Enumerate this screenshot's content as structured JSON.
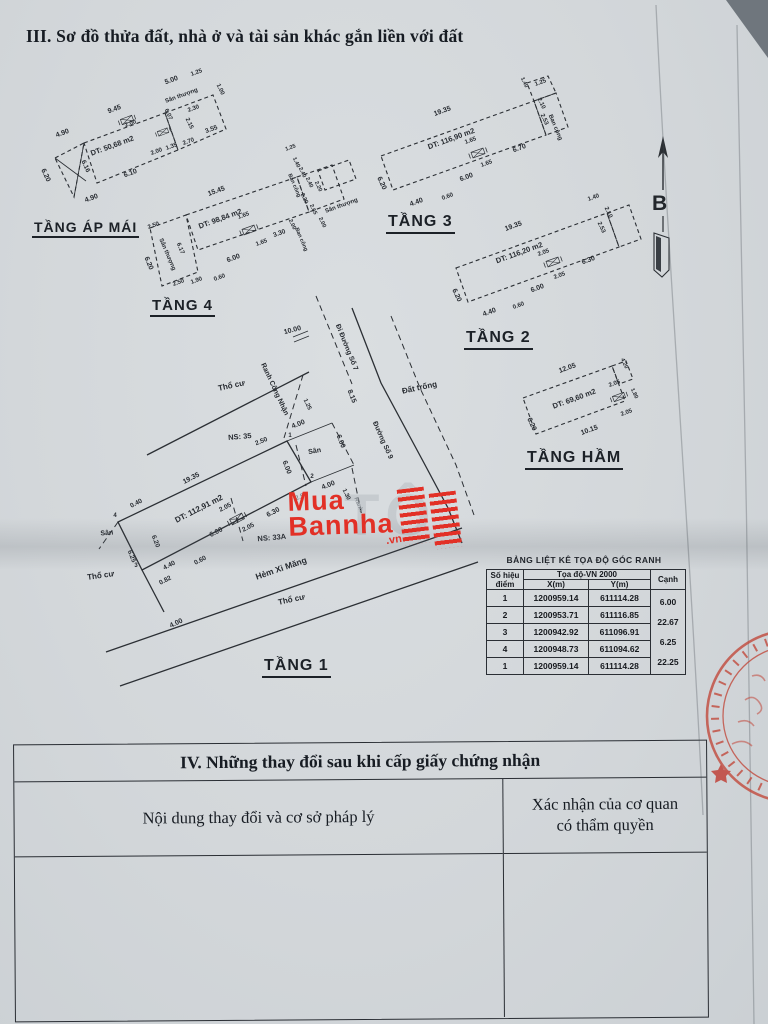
{
  "title": "III. Sơ đồ thửa đất, nhà ở và tài sản khác gắn liền với đất",
  "north": {
    "label": "B"
  },
  "watermark": {
    "l1": "Mua",
    "l2": "Bannha",
    "vn": ".vn",
    "ghost": "TÔ",
    "color": "#e23026"
  },
  "floor_labels": [
    {
      "t": "TẦNG ÁP MÁI",
      "x": 32,
      "y": 219,
      "s": 14
    },
    {
      "t": "TẦNG 4",
      "x": 150,
      "y": 297,
      "s": 15
    },
    {
      "t": "TẦNG 3",
      "x": 386,
      "y": 213,
      "s": 16
    },
    {
      "t": "TẦNG 2",
      "x": 464,
      "y": 329,
      "s": 16
    },
    {
      "t": "TẦNG HẦM",
      "x": 525,
      "y": 449,
      "s": 16
    },
    {
      "t": "TẦNG 1",
      "x": 262,
      "y": 657,
      "s": 16
    }
  ],
  "coord_table": {
    "title": "BẢNG LIỆT KÊ TỌA ĐỘ GÓC RANH",
    "header": {
      "point_l1": "Số hiệu",
      "point_l2": "điểm",
      "coord": "Tọa độ-VN 2000",
      "x": "X(m)",
      "y": "Y(m)",
      "edge": "Cạnh"
    },
    "rows": [
      {
        "pt": "1",
        "x": "1200959.14",
        "y": "611114.28"
      },
      {
        "pt": "2",
        "x": "1200953.71",
        "y": "611116.85"
      },
      {
        "pt": "3",
        "x": "1200942.92",
        "y": "611096.91"
      },
      {
        "pt": "4",
        "x": "1200948.73",
        "y": "611094.62"
      },
      {
        "pt": "1",
        "x": "1200959.14",
        "y": "611114.28"
      }
    ],
    "edges": [
      "6.00",
      "22.67",
      "6.25",
      "22.25"
    ]
  },
  "section4": {
    "title": "IV. Những thay đổi sau khi cấp giấy chứng nhận",
    "col_content": "Nội dung thay đổi và cơ sở pháp lý",
    "col_confirm_l1": "Xác nhận của cơ quan",
    "col_confirm_l2": "có thẩm quyền"
  },
  "drawing": {
    "labels": [
      {
        "t": "9.45",
        "x": 115,
        "y": 111,
        "r": -20,
        "s": 7
      },
      {
        "t": "5.00",
        "x": 172,
        "y": 82,
        "r": -20,
        "s": 7
      },
      {
        "t": "1.25",
        "x": 197,
        "y": 74,
        "r": -20,
        "s": 6
      },
      {
        "t": "4.90",
        "x": 63,
        "y": 135,
        "r": -20,
        "s": 7
      },
      {
        "t": "6.20",
        "x": 44,
        "y": 176,
        "r": 65,
        "s": 7
      },
      {
        "t": "6.16",
        "x": 84,
        "y": 167,
        "r": 65,
        "s": 6.5
      },
      {
        "t": "4.90",
        "x": 92,
        "y": 200,
        "r": -20,
        "s": 7
      },
      {
        "t": "DT: 50,68 m2",
        "x": 113,
        "y": 148,
        "r": -20,
        "s": 7.5
      },
      {
        "t": "Sân thượng",
        "x": 182,
        "y": 97,
        "r": -20,
        "s": 6
      },
      {
        "t": "2.00",
        "x": 131,
        "y": 125,
        "r": -20,
        "s": 6
      },
      {
        "t": "6.07",
        "x": 167,
        "y": 115,
        "r": 65,
        "s": 6
      },
      {
        "t": "2.30",
        "x": 194,
        "y": 110,
        "r": -20,
        "s": 6
      },
      {
        "t": "2.15",
        "x": 188,
        "y": 124,
        "r": 65,
        "s": 6
      },
      {
        "t": "3.55",
        "x": 212,
        "y": 131,
        "r": -20,
        "s": 6.5
      },
      {
        "t": "2.00",
        "x": 157,
        "y": 153,
        "r": -20,
        "s": 6
      },
      {
        "t": "1.35",
        "x": 172,
        "y": 148,
        "r": -20,
        "s": 6
      },
      {
        "t": "2.70",
        "x": 189,
        "y": 143,
        "r": -20,
        "s": 6
      },
      {
        "t": "6.10",
        "x": 131,
        "y": 175,
        "r": -20,
        "s": 7
      },
      {
        "t": "1.00",
        "x": 219,
        "y": 90,
        "r": 65,
        "s": 6
      },
      {
        "t": "15.45",
        "x": 217,
        "y": 193,
        "r": -20,
        "s": 7
      },
      {
        "t": "2.50",
        "x": 154,
        "y": 227,
        "r": -20,
        "s": 6
      },
      {
        "t": "Sân thượng",
        "x": 166,
        "y": 255,
        "r": 67,
        "s": 6
      },
      {
        "t": "6.20",
        "x": 147,
        "y": 264,
        "r": 67,
        "s": 7
      },
      {
        "t": "6.17",
        "x": 179,
        "y": 249,
        "r": 67,
        "s": 6
      },
      {
        "t": "DT: 98,84 m2",
        "x": 221,
        "y": 221,
        "r": -20,
        "s": 7.5
      },
      {
        "t": "1.65",
        "x": 244,
        "y": 217,
        "r": -20,
        "s": 6
      },
      {
        "t": "6.00",
        "x": 234,
        "y": 260,
        "r": -20,
        "s": 7
      },
      {
        "t": "1.65",
        "x": 262,
        "y": 244,
        "r": -20,
        "s": 6
      },
      {
        "t": "3.30",
        "x": 280,
        "y": 235,
        "r": -20,
        "s": 6.5
      },
      {
        "t": "2.50",
        "x": 179,
        "y": 284,
        "r": -20,
        "s": 6
      },
      {
        "t": "1.90",
        "x": 197,
        "y": 282,
        "r": -20,
        "s": 6
      },
      {
        "t": "0.60",
        "x": 220,
        "y": 279,
        "r": -20,
        "s": 6
      },
      {
        "t": "1.25",
        "x": 291,
        "y": 149,
        "r": -20,
        "s": 5.5
      },
      {
        "t": "1.40",
        "x": 295,
        "y": 163,
        "r": 65,
        "s": 5.5
      },
      {
        "t": "2.40",
        "x": 301,
        "y": 173,
        "r": 65,
        "s": 5.5
      },
      {
        "t": "2.40",
        "x": 308,
        "y": 183,
        "r": 65,
        "s": 5.5
      },
      {
        "t": "2.20",
        "x": 317,
        "y": 187,
        "r": 65,
        "s": 5.5
      },
      {
        "t": "Ban công",
        "x": 293,
        "y": 186,
        "r": 67,
        "s": 5.5
      },
      {
        "t": "2.20",
        "x": 303,
        "y": 199,
        "r": 65,
        "s": 5.5
      },
      {
        "t": "2.65",
        "x": 312,
        "y": 210,
        "r": 65,
        "s": 5.5
      },
      {
        "t": "2.00",
        "x": 321,
        "y": 223,
        "r": 65,
        "s": 5.5
      },
      {
        "t": "Sân thượng",
        "x": 342,
        "y": 207,
        "r": -20,
        "s": 6
      },
      {
        "t": "2.00",
        "x": 291,
        "y": 225,
        "r": 65,
        "s": 5.5
      },
      {
        "t": "Ban công",
        "x": 300,
        "y": 240,
        "r": 67,
        "s": 5.5
      },
      {
        "t": "19.35",
        "x": 443,
        "y": 113,
        "r": -20,
        "s": 7
      },
      {
        "t": "DT: 116,90 m2",
        "x": 452,
        "y": 141,
        "r": -20,
        "s": 7.5
      },
      {
        "t": "1.25",
        "x": 541,
        "y": 84,
        "r": -20,
        "s": 6
      },
      {
        "t": "1.40",
        "x": 523,
        "y": 83,
        "r": 65,
        "s": 5.5
      },
      {
        "t": "2.10",
        "x": 540,
        "y": 104,
        "r": 65,
        "s": 6
      },
      {
        "t": "2.53",
        "x": 543,
        "y": 120,
        "r": 65,
        "s": 6
      },
      {
        "t": "Ban công",
        "x": 554,
        "y": 128,
        "r": 67,
        "s": 6
      },
      {
        "t": "1.65",
        "x": 471,
        "y": 142,
        "r": -20,
        "s": 6
      },
      {
        "t": "6.70",
        "x": 520,
        "y": 150,
        "r": -20,
        "s": 7
      },
      {
        "t": "1.65",
        "x": 487,
        "y": 165,
        "r": -20,
        "s": 6
      },
      {
        "t": "6.00",
        "x": 467,
        "y": 179,
        "r": -20,
        "s": 7
      },
      {
        "t": "6.20",
        "x": 380,
        "y": 184,
        "r": 65,
        "s": 7
      },
      {
        "t": "4.40",
        "x": 417,
        "y": 204,
        "r": -20,
        "s": 7
      },
      {
        "t": "0.60",
        "x": 448,
        "y": 198,
        "r": -20,
        "s": 6
      },
      {
        "t": "19.35",
        "x": 514,
        "y": 228,
        "r": -20,
        "s": 7
      },
      {
        "t": "DT: 116,20 m2",
        "x": 520,
        "y": 255,
        "r": -20,
        "s": 7.5
      },
      {
        "t": "1.40",
        "x": 594,
        "y": 199,
        "r": -20,
        "s": 6
      },
      {
        "t": "2.10",
        "x": 607,
        "y": 213,
        "r": 65,
        "s": 6
      },
      {
        "t": "2.53",
        "x": 600,
        "y": 228,
        "r": 65,
        "s": 6
      },
      {
        "t": "2.05",
        "x": 544,
        "y": 254,
        "r": -20,
        "s": 6
      },
      {
        "t": "6.30",
        "x": 589,
        "y": 262,
        "r": -20,
        "s": 7
      },
      {
        "t": "2.05",
        "x": 560,
        "y": 277,
        "r": -20,
        "s": 6
      },
      {
        "t": "6.00",
        "x": 538,
        "y": 290,
        "r": -20,
        "s": 7
      },
      {
        "t": "6.20",
        "x": 455,
        "y": 296,
        "r": 65,
        "s": 7
      },
      {
        "t": "4.40",
        "x": 490,
        "y": 314,
        "r": -20,
        "s": 7
      },
      {
        "t": "0.60",
        "x": 519,
        "y": 307,
        "r": -20,
        "s": 6
      },
      {
        "t": "12.05",
        "x": 568,
        "y": 370,
        "r": -20,
        "s": 7
      },
      {
        "t": "DT: 69,60 m2",
        "x": 575,
        "y": 401,
        "r": -20,
        "s": 7.5
      },
      {
        "t": "2.05",
        "x": 615,
        "y": 385,
        "r": -20,
        "s": 6
      },
      {
        "t": "2.05",
        "x": 627,
        "y": 414,
        "r": -20,
        "s": 6
      },
      {
        "t": "4.20",
        "x": 623,
        "y": 364,
        "r": 65,
        "s": 5.5
      },
      {
        "t": "1.80",
        "x": 633,
        "y": 394,
        "r": 65,
        "s": 5.5
      },
      {
        "t": "6.20",
        "x": 530,
        "y": 425,
        "r": 65,
        "s": 7
      },
      {
        "t": "10.15",
        "x": 590,
        "y": 432,
        "r": -20,
        "s": 7
      },
      {
        "t": "10.00",
        "x": 293,
        "y": 332,
        "r": -15,
        "s": 7
      },
      {
        "t": "Đi Đường Số 7",
        "x": 345,
        "y": 348,
        "r": 68,
        "s": 7
      },
      {
        "t": "Đường Số 9",
        "x": 381,
        "y": 441,
        "r": 66,
        "s": 7
      },
      {
        "t": "8.15",
        "x": 350,
        "y": 397,
        "r": 68,
        "s": 7
      },
      {
        "t": "Đất trống",
        "x": 420,
        "y": 390,
        "r": -12,
        "s": 8
      },
      {
        "t": "Thổ cư",
        "x": 232,
        "y": 388,
        "r": -12,
        "s": 8
      },
      {
        "t": "Ranh Công Nhận",
        "x": 273,
        "y": 390,
        "r": 65,
        "s": 7
      },
      {
        "t": "1.25",
        "x": 306,
        "y": 405,
        "r": 65,
        "s": 6
      },
      {
        "t": "NS: 35",
        "x": 240,
        "y": 439,
        "r": -5,
        "s": 7.5
      },
      {
        "t": "2.50",
        "x": 262,
        "y": 443,
        "r": -22,
        "s": 6.5
      },
      {
        "t": "4.00",
        "x": 299,
        "y": 426,
        "r": -22,
        "s": 7
      },
      {
        "t": "6.00",
        "x": 285,
        "y": 468,
        "r": 68,
        "s": 7
      },
      {
        "t": "6.00",
        "x": 339,
        "y": 442,
        "r": 68,
        "s": 7
      },
      {
        "t": "Sân",
        "x": 315,
        "y": 453,
        "r": -10,
        "s": 7
      },
      {
        "t": "4.00",
        "x": 329,
        "y": 487,
        "r": -22,
        "s": 7
      },
      {
        "t": "1.30",
        "x": 345,
        "y": 495,
        "r": 65,
        "s": 6
      },
      {
        "t": "2.50",
        "x": 302,
        "y": 498,
        "r": -22,
        "s": 6.5,
        "c": "g"
      },
      {
        "t": "Ranh",
        "x": 357,
        "y": 505,
        "r": 68,
        "s": 6,
        "c": "g"
      },
      {
        "t": "19.35",
        "x": 192,
        "y": 480,
        "r": -27,
        "s": 7
      },
      {
        "t": "DT: 112,91 m2",
        "x": 200,
        "y": 511,
        "r": -27,
        "s": 8
      },
      {
        "t": "2.05",
        "x": 226,
        "y": 509,
        "r": -27,
        "s": 6.5
      },
      {
        "t": "6.30",
        "x": 274,
        "y": 514,
        "r": -27,
        "s": 7
      },
      {
        "t": "2.05",
        "x": 249,
        "y": 529,
        "r": -27,
        "s": 6.5
      },
      {
        "t": "6.00",
        "x": 217,
        "y": 534,
        "r": -27,
        "s": 7
      },
      {
        "t": "NS: 33A",
        "x": 272,
        "y": 540,
        "r": -5,
        "s": 7.5
      },
      {
        "t": "0.40",
        "x": 137,
        "y": 505,
        "r": -27,
        "s": 6.5
      },
      {
        "t": "Sân",
        "x": 107,
        "y": 535,
        "r": -5,
        "s": 7
      },
      {
        "t": "6.20",
        "x": 154,
        "y": 542,
        "r": 68,
        "s": 6.5
      },
      {
        "t": "6.25",
        "x": 130,
        "y": 557,
        "r": 68,
        "s": 6.5
      },
      {
        "t": "4.40",
        "x": 170,
        "y": 567,
        "r": -27,
        "s": 6.5
      },
      {
        "t": "0.60",
        "x": 201,
        "y": 562,
        "r": -27,
        "s": 6.5
      },
      {
        "t": "0.82",
        "x": 166,
        "y": 582,
        "r": -27,
        "s": 6.5
      },
      {
        "t": "Thổ cư",
        "x": 101,
        "y": 578,
        "r": -8,
        "s": 8
      },
      {
        "t": "Hẻm Xi Măng",
        "x": 282,
        "y": 571,
        "r": -19,
        "s": 8.5
      },
      {
        "t": "Thổ cư",
        "x": 292,
        "y": 602,
        "r": -12,
        "s": 8
      },
      {
        "t": "4.00",
        "x": 177,
        "y": 625,
        "r": -25,
        "s": 7
      },
      {
        "t": "4",
        "x": 115,
        "y": 517,
        "r": 0,
        "s": 6
      },
      {
        "t": "3",
        "x": 136,
        "y": 567,
        "r": 0,
        "s": 6
      },
      {
        "t": "1",
        "x": 290,
        "y": 437,
        "r": 0,
        "s": 6
      },
      {
        "t": "2",
        "x": 312,
        "y": 478,
        "r": 0,
        "s": 6
      }
    ]
  }
}
